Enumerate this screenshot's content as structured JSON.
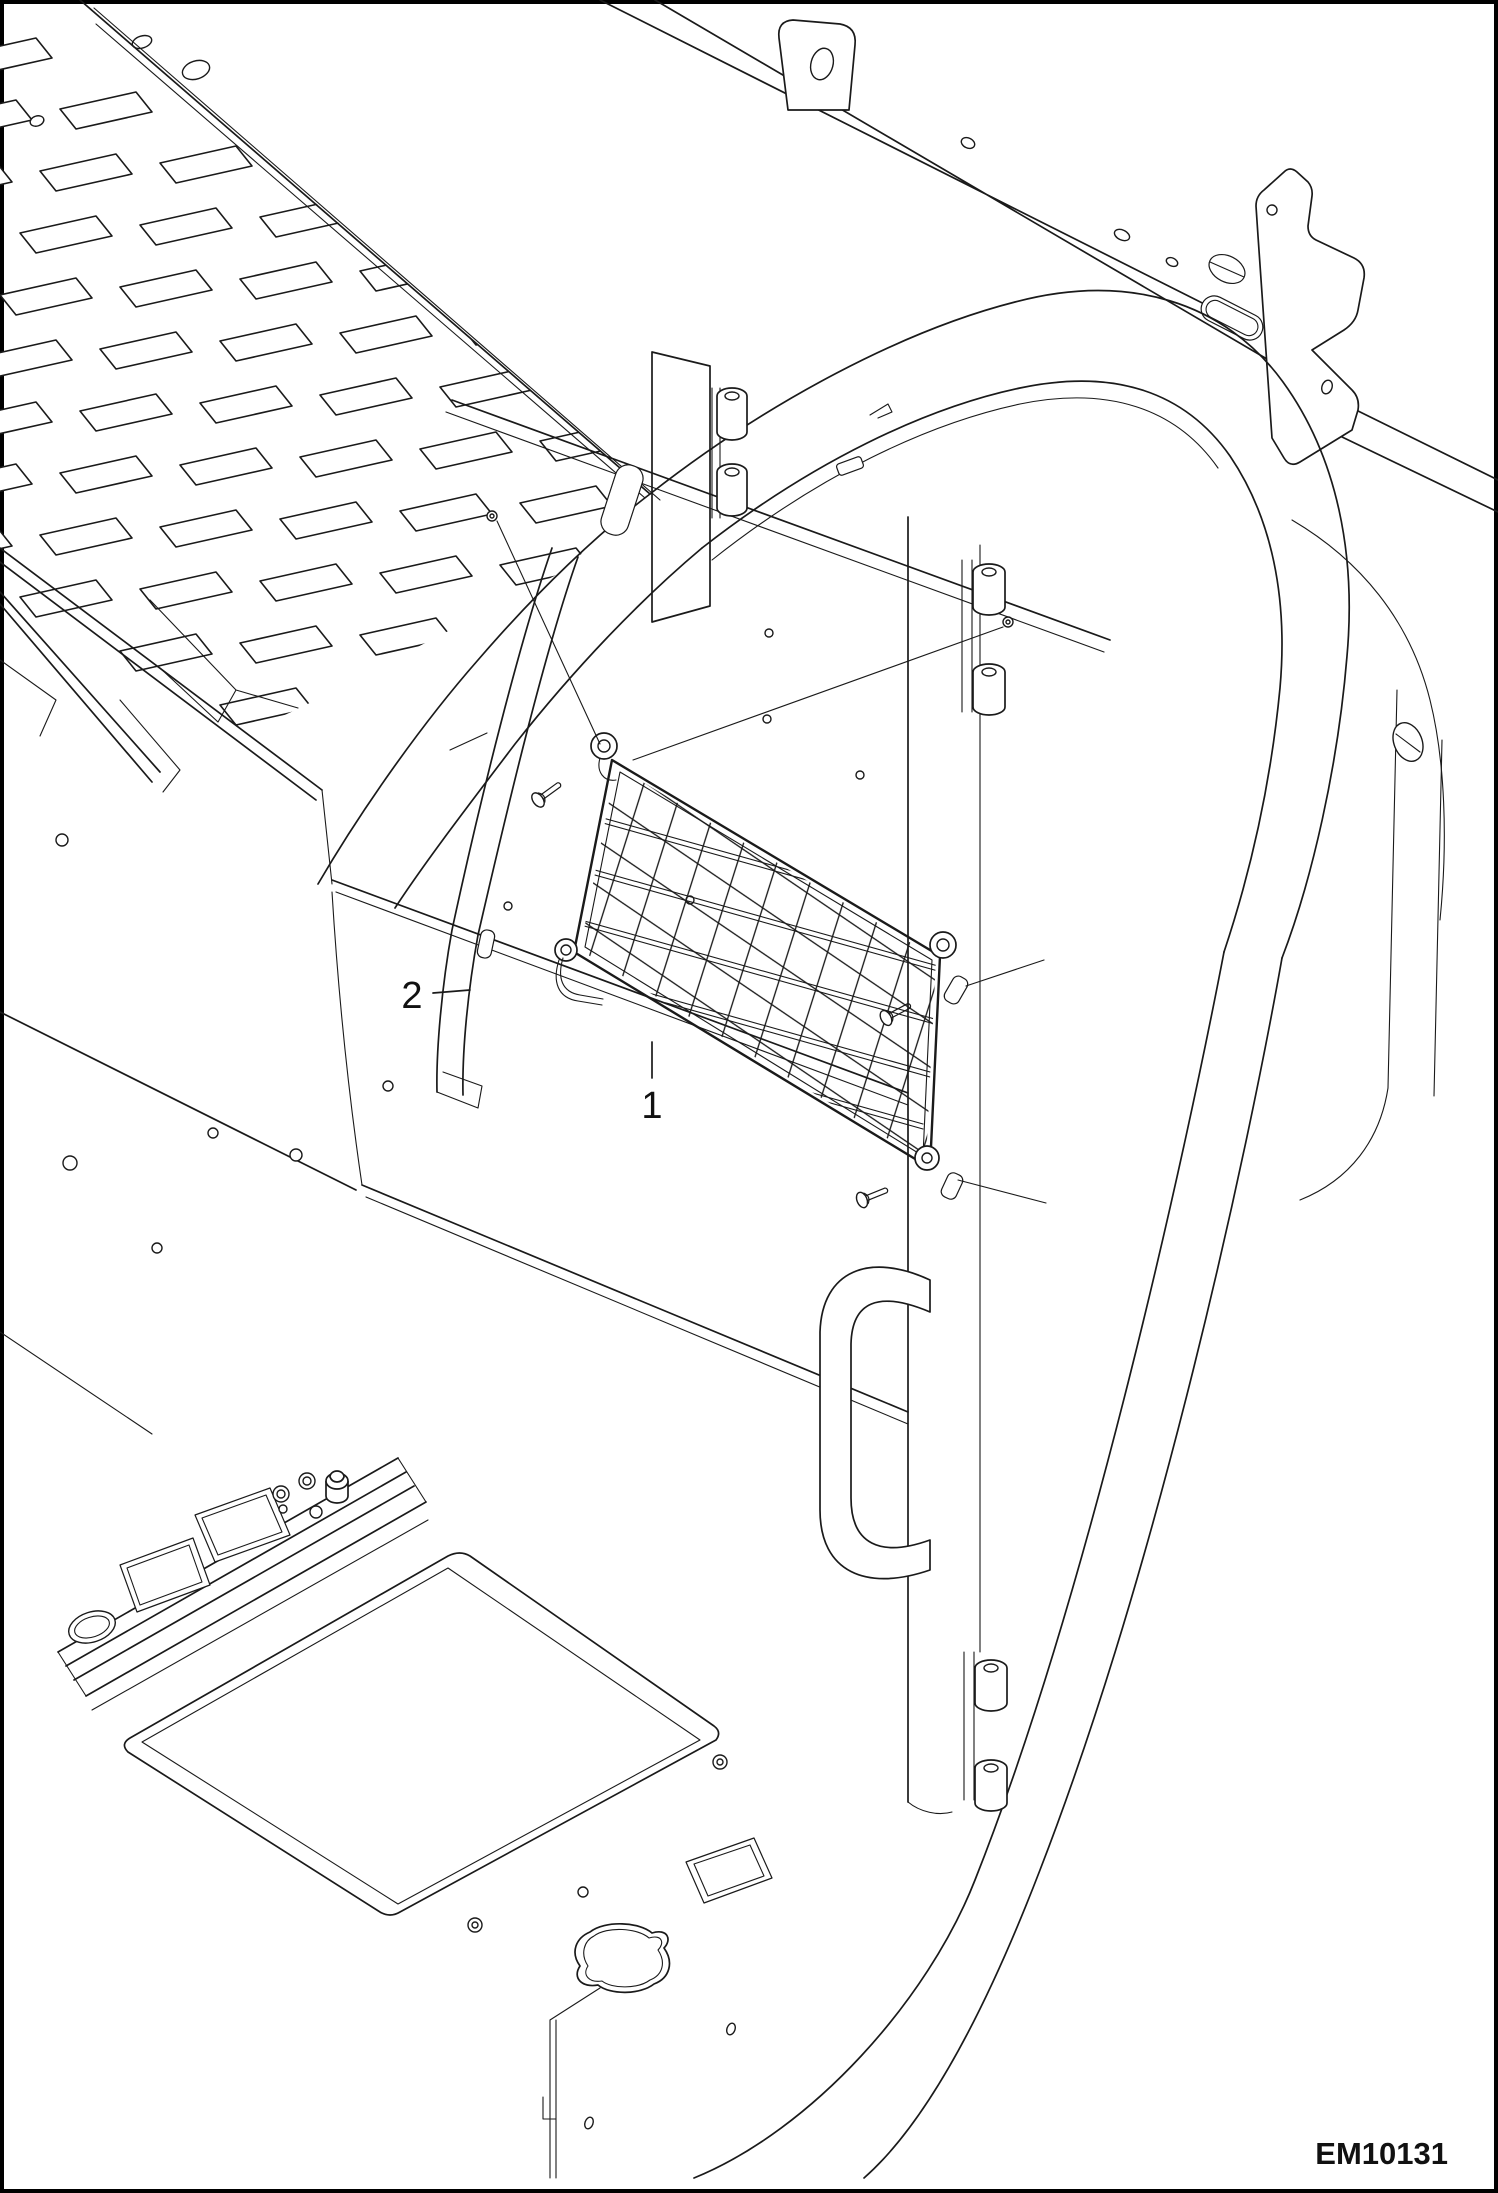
{
  "drawing": {
    "id": "EM10131"
  },
  "callouts": [
    {
      "label": "1"
    },
    {
      "label": "2"
    }
  ],
  "colors": {
    "background": "#ffffff",
    "line": "#1a1a1a"
  }
}
